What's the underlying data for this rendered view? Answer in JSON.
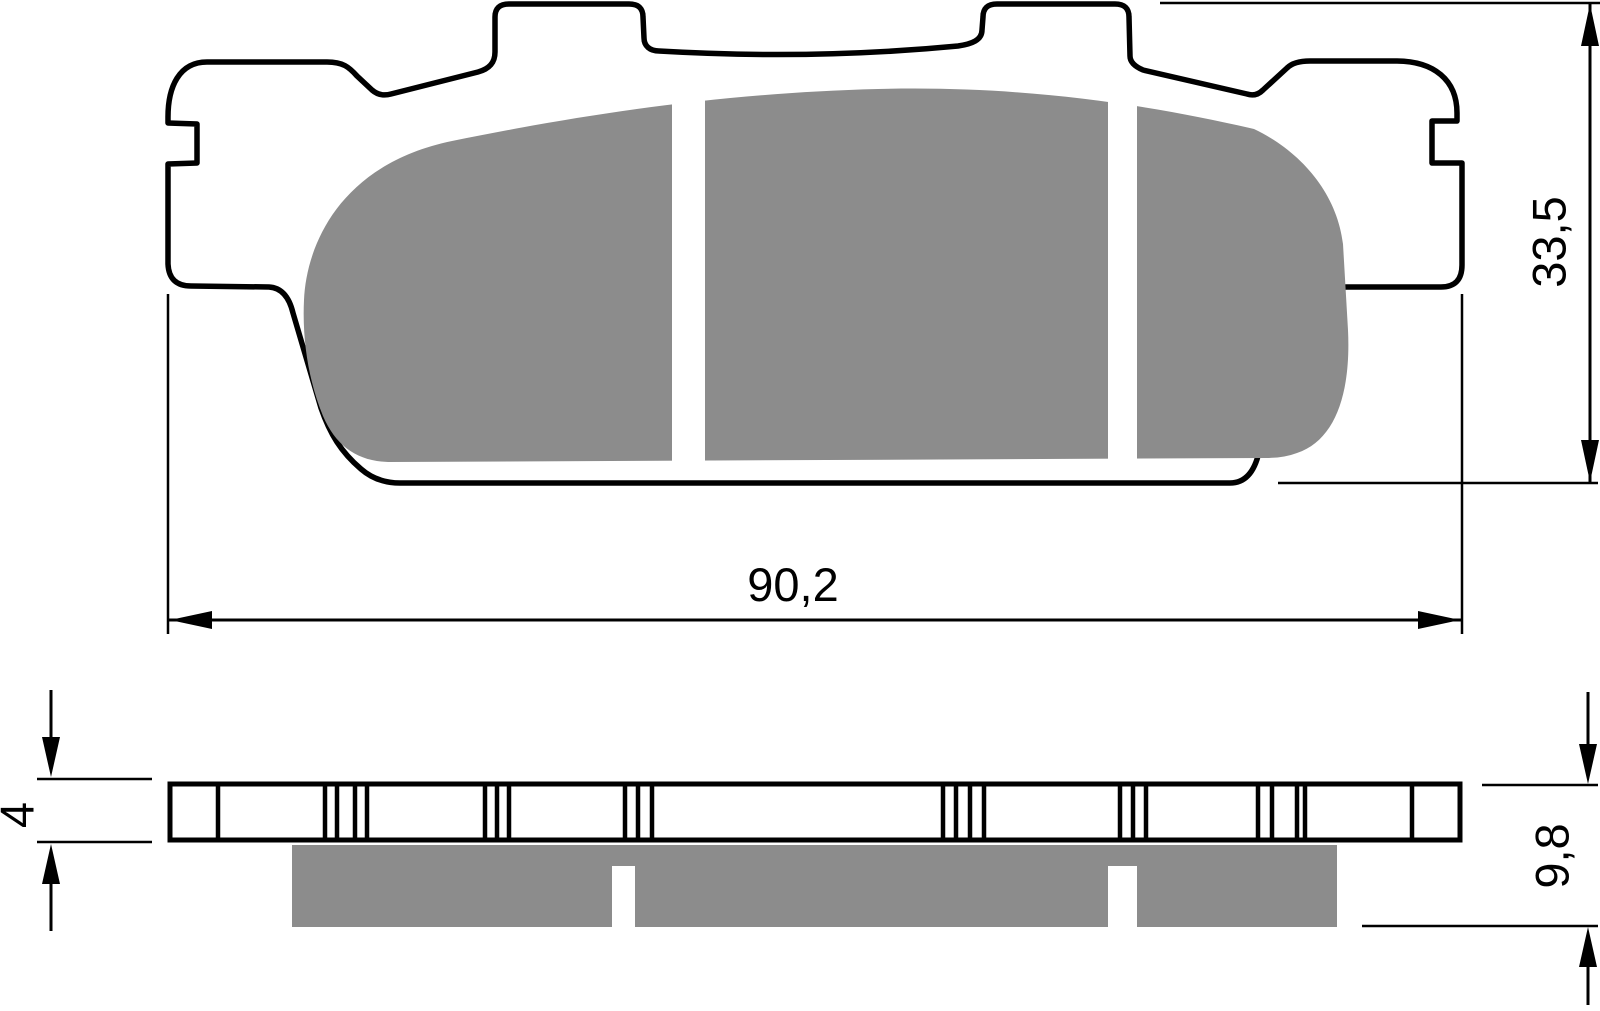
{
  "drawing": {
    "type": "brake-pad-technical-drawing",
    "dimensions": {
      "width": {
        "label": "90,2"
      },
      "height": {
        "label": "33,5"
      },
      "plate_thickness": {
        "label": "4"
      },
      "total_thickness": {
        "label": "9,8"
      }
    }
  },
  "colors": {
    "line": "#000000",
    "friction_gray": "#8c8c8c",
    "background": "#ffffff"
  }
}
